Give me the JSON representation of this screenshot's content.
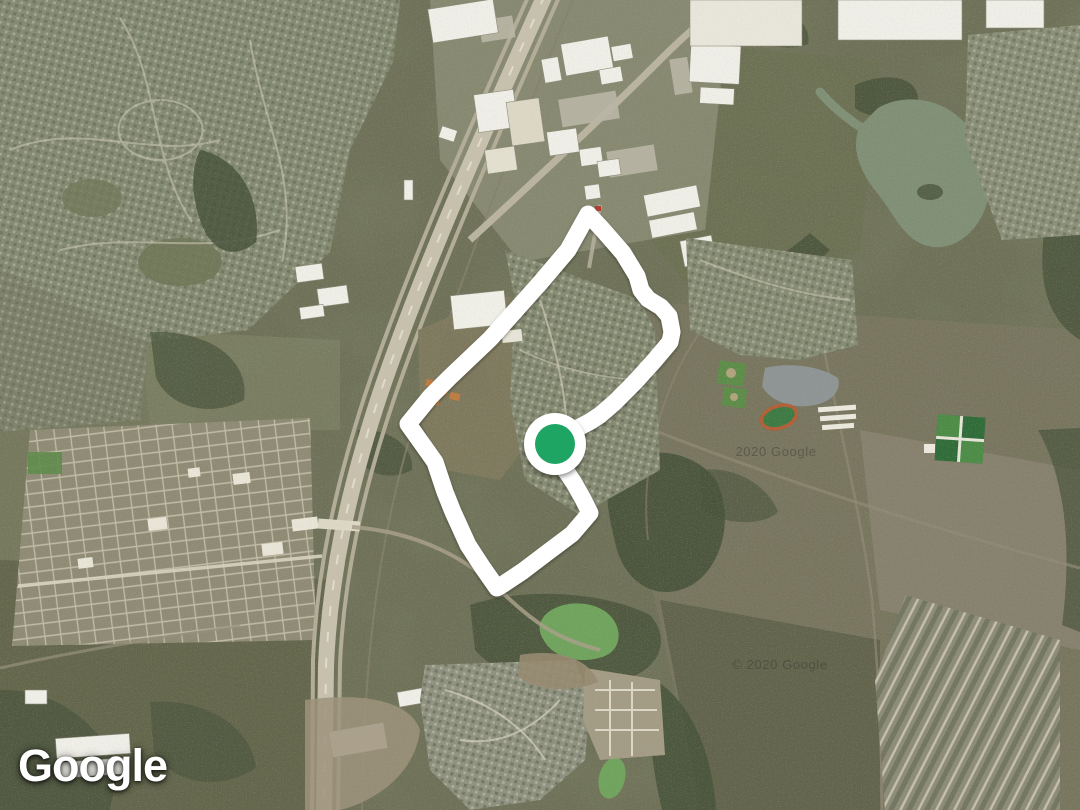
{
  "map": {
    "imagery_type": "satellite",
    "attribution_logo": "Google",
    "watermarks": [
      {
        "text": "2020 Google",
        "x": 776,
        "y": 456
      },
      {
        "text": "© 2020 Google",
        "x": 780,
        "y": 669
      }
    ]
  },
  "route": {
    "stroke_color": "#ffffff",
    "stroke_width": 17,
    "points": "588,214 603,230 623,253 637,276 641,290 648,299 661,307 669,316 672,332 670,342 654,361 634,383 614,403 600,415 591,421 576,429 562,440 558,450 562,466 568,474 574,483 583,499 590,513 572,534 548,552 523,571 502,585 497,588 483,568 468,545 453,512 445,492 435,462 418,438 408,424 430,397 450,377 490,339 540,283 568,250"
  },
  "marker": {
    "cx": 555,
    "cy": 444,
    "ring_radius": 31,
    "dot_radius": 20,
    "ring_color": "#ffffff",
    "dot_color": "#1ea563"
  }
}
